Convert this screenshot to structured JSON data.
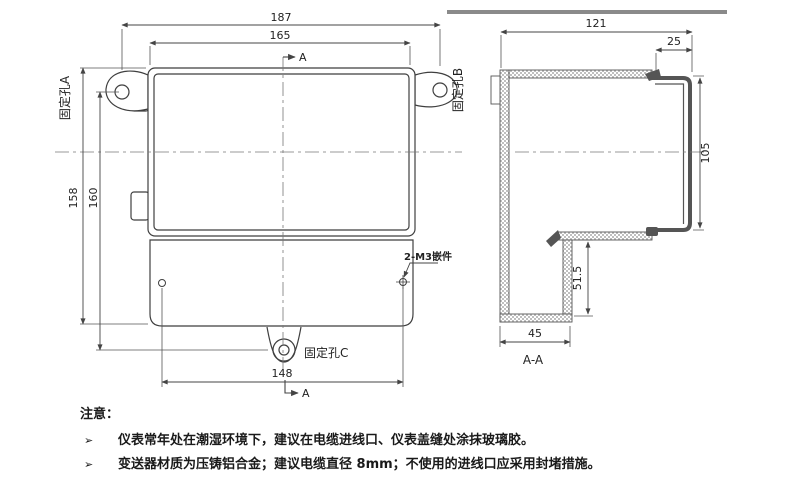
{
  "front": {
    "dim_187": "187",
    "dim_165": "165",
    "dim_158": "158",
    "dim_160": "160",
    "dim_148": "148",
    "hole_a": "固定孔A",
    "hole_b": "固定孔B",
    "hole_c": "固定孔C",
    "insert_label": "2-M3嵌件",
    "section_letter_top": "A",
    "section_letter_bottom": "A"
  },
  "section": {
    "dim_121": "121",
    "dim_25": "25",
    "dim_105": "105",
    "dim_51_5": "51.5",
    "dim_45": "45",
    "title": "A-A"
  },
  "notes": {
    "title": "注意：",
    "bullet": "➢",
    "items": [
      "仪表常年处在潮湿环境下，建议在电缆进线口、仪表盖缝处涂抹玻璃胶。",
      "变送器材质为压铸铝合金；建议电缆直径 8mm；不使用的进线口应采用封堵措施。"
    ]
  }
}
